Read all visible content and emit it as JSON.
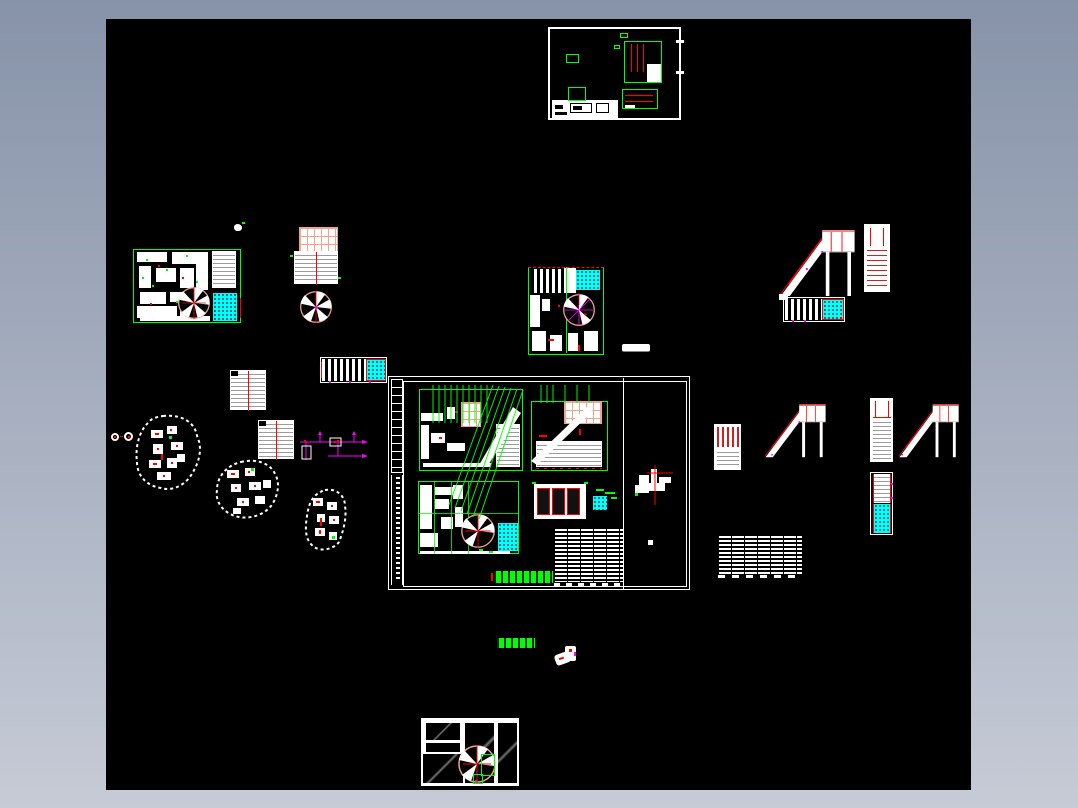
{
  "viewer": {
    "background_top": "#8793a9",
    "background_bottom": "#c6cbd6",
    "canvas_color": "#000000"
  },
  "palette": {
    "white": "#ffffff",
    "green": "#00ff00",
    "red": "#ff0000",
    "cyan": "#00ffff",
    "magenta": "#ff00ff",
    "salmon": "#f2a38e",
    "gray": "#9b9b9b",
    "darkred": "#cc2222"
  },
  "drawings": {
    "top_sheet": "framed detail sheet with title block",
    "left_cluster": "floor plan with spiral stair and hatched shaft",
    "grid_cluster": "roof grid, stair run plan and spiral stair",
    "center_cluster": "plan with spiral stair and hatched shaft",
    "main_sheet": "assembly sheet with plans, schedule table and notes",
    "stair_group_top": "stair elevation, ladder view and tread plan",
    "stair_group_mid": "two stair elevations, ladders and tread plans",
    "site_blobs": "three dashed site outlines with furniture blocks",
    "bottom_sheet": "panel layout with spiral stair detail"
  }
}
